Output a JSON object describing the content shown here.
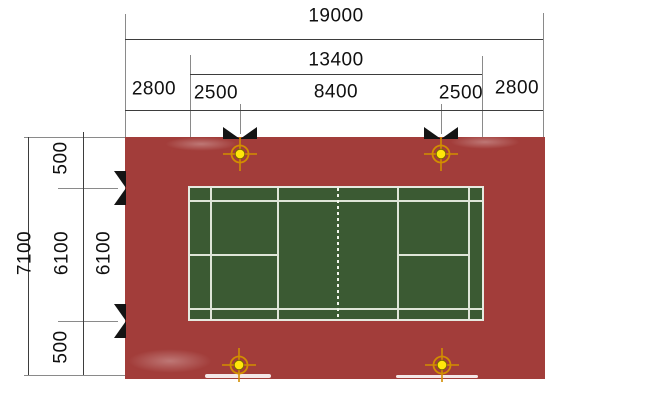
{
  "dimensions_top": {
    "overall": "19000",
    "court_length": "13400",
    "segments": [
      "2800",
      "2500",
      "8400",
      "2500",
      "2800"
    ]
  },
  "dimensions_left": {
    "overall": "7100",
    "segments": [
      "500",
      "6100",
      "500"
    ],
    "court_width": "6100"
  },
  "colors": {
    "apron_red": "#a23d3a",
    "court_green": "#3b5a33",
    "court_line_white": "#dfe5d8",
    "post_ring_orange": "#d28e00",
    "post_dot_yellow": "#ffe60a",
    "dimension_marker_black": "#141414",
    "dimension_line_gray": "#3d3d3d"
  },
  "icons": {
    "light_post": "crosshair-circle-marker",
    "dimension_node": "black-bowtie-marker"
  }
}
